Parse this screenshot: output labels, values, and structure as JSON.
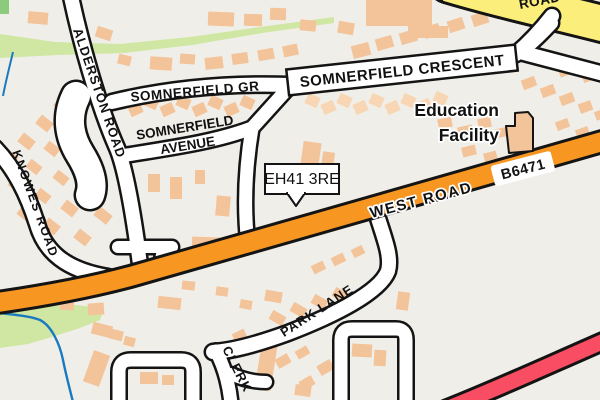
{
  "map": {
    "postcode_callout": {
      "text": "EH41 3RE"
    },
    "labels": {
      "alderston_road": "ALDERSTON ROAD",
      "somnerfield_gr": "SOMNERFIELD GR",
      "somnerfield_crescent": "SOMNERFIELD CRESCENT",
      "somnerfield_avenue_line1": "SOMNERFIELD",
      "somnerfield_avenue_line2": "AVENUE",
      "knowes_road": "KNOWES ROAD",
      "west_road": "WEST ROAD",
      "route_ref": "B6471",
      "park_lane": "PARK LANE",
      "clerk_partial": "CLERK",
      "top_road_partial": "ROAD",
      "education_facility_line1": "Education",
      "education_facility_line2": "Facility"
    },
    "colors": {
      "background": "#f0eee8",
      "building": "#f3c39a",
      "building_light": "#f8d6b4",
      "green_area": "#cfe7a2",
      "green_dark": "#8ccb7d",
      "stream_blue": "#1a7ac0",
      "road_outline": "#141414",
      "road_white": "#ffffff",
      "road_orange": "#f79722",
      "road_yellow": "#fbee7a",
      "road_red": "#f84d62"
    },
    "buildings": [
      [
        55,
        100,
        15,
        11,
        38
      ],
      [
        37,
        118,
        15,
        11,
        38
      ],
      [
        19,
        136,
        15,
        11,
        38
      ],
      [
        3,
        152,
        14,
        10,
        38
      ],
      [
        63,
        126,
        14,
        10,
        38
      ],
      [
        45,
        144,
        14,
        10,
        38
      ],
      [
        27,
        162,
        14,
        10,
        38
      ],
      [
        9,
        180,
        14,
        10,
        38
      ],
      [
        72,
        155,
        14,
        10,
        38
      ],
      [
        54,
        173,
        14,
        10,
        38
      ],
      [
        36,
        191,
        14,
        10,
        38
      ],
      [
        18,
        209,
        14,
        10,
        38
      ],
      [
        80,
        185,
        15,
        11,
        38
      ],
      [
        62,
        203,
        15,
        11,
        38
      ],
      [
        44,
        221,
        15,
        11,
        38
      ],
      [
        95,
        210,
        16,
        11,
        38
      ],
      [
        75,
        232,
        15,
        11,
        38
      ],
      [
        28,
        12,
        20,
        12,
        5
      ],
      [
        96,
        28,
        16,
        11,
        18
      ],
      [
        118,
        55,
        13,
        10,
        14
      ],
      [
        150,
        57,
        22,
        13,
        4
      ],
      [
        180,
        54,
        15,
        10,
        4
      ],
      [
        208,
        12,
        26,
        14,
        2
      ],
      [
        244,
        14,
        18,
        12,
        2
      ],
      [
        270,
        8,
        16,
        12,
        2
      ],
      [
        300,
        20,
        16,
        11,
        6
      ],
      [
        338,
        22,
        16,
        12,
        10
      ],
      [
        366,
        0,
        66,
        26,
        0
      ],
      [
        408,
        26,
        40,
        12,
        0
      ],
      [
        352,
        44,
        18,
        13,
        -14
      ],
      [
        376,
        37,
        17,
        12,
        -16
      ],
      [
        400,
        31,
        17,
        12,
        -16
      ],
      [
        424,
        25,
        16,
        12,
        -16
      ],
      [
        448,
        19,
        16,
        12,
        -18
      ],
      [
        472,
        13,
        16,
        12,
        -18
      ],
      [
        205,
        57,
        18,
        12,
        -6
      ],
      [
        232,
        53,
        16,
        11,
        -8
      ],
      [
        258,
        49,
        16,
        11,
        -10
      ],
      [
        283,
        45,
        15,
        11,
        -12
      ],
      [
        113,
        97,
        13,
        11,
        24
      ],
      [
        129,
        104,
        13,
        11,
        -24
      ],
      [
        145,
        97,
        13,
        11,
        24
      ],
      [
        161,
        104,
        13,
        11,
        -24
      ],
      [
        177,
        97,
        13,
        11,
        24
      ],
      [
        193,
        104,
        13,
        11,
        -24
      ],
      [
        209,
        97,
        13,
        11,
        24
      ],
      [
        225,
        104,
        13,
        11,
        -24
      ],
      [
        241,
        97,
        13,
        11,
        24
      ],
      [
        306,
        95,
        13,
        11,
        24,
        1
      ],
      [
        322,
        102,
        13,
        11,
        -24,
        1
      ],
      [
        338,
        95,
        13,
        11,
        24,
        1
      ],
      [
        354,
        102,
        13,
        11,
        -24,
        1
      ],
      [
        370,
        95,
        13,
        11,
        24,
        1
      ],
      [
        386,
        102,
        13,
        11,
        -24,
        1
      ],
      [
        402,
        95,
        13,
        11,
        24,
        1
      ],
      [
        418,
        100,
        13,
        11,
        -24,
        1
      ],
      [
        434,
        93,
        13,
        11,
        24,
        1
      ],
      [
        522,
        78,
        14,
        10,
        -20
      ],
      [
        541,
        86,
        14,
        10,
        -20
      ],
      [
        560,
        94,
        14,
        10,
        -20
      ],
      [
        579,
        102,
        13,
        10,
        -20
      ],
      [
        595,
        110,
        12,
        9,
        -20
      ],
      [
        556,
        120,
        13,
        9,
        -20
      ],
      [
        576,
        128,
        13,
        9,
        -20
      ],
      [
        592,
        136,
        11,
        9,
        -20
      ],
      [
        558,
        62,
        18,
        13,
        -20
      ],
      [
        582,
        70,
        14,
        11,
        -20
      ],
      [
        438,
        118,
        14,
        10,
        -12
      ],
      [
        458,
        126,
        15,
        11,
        -12
      ],
      [
        478,
        118,
        13,
        10,
        -12
      ],
      [
        496,
        128,
        12,
        9,
        -12
      ],
      [
        462,
        146,
        14,
        10,
        -14
      ],
      [
        484,
        152,
        13,
        10,
        -14
      ],
      [
        148,
        174,
        12,
        18,
        0
      ],
      [
        170,
        177,
        12,
        22,
        0
      ],
      [
        195,
        170,
        10,
        14,
        0
      ],
      [
        192,
        237,
        28,
        11,
        2
      ],
      [
        216,
        196,
        14,
        20,
        5
      ],
      [
        302,
        142,
        18,
        24,
        8
      ],
      [
        322,
        152,
        12,
        16,
        8
      ],
      [
        288,
        170,
        13,
        10,
        10
      ],
      [
        60,
        300,
        14,
        10,
        2
      ],
      [
        88,
        303,
        16,
        12,
        -4
      ],
      [
        92,
        324,
        20,
        12,
        14
      ],
      [
        110,
        330,
        13,
        10,
        14
      ],
      [
        124,
        337,
        11,
        9,
        14
      ],
      [
        158,
        297,
        23,
        12,
        6
      ],
      [
        182,
        281,
        13,
        9,
        6
      ],
      [
        216,
        287,
        12,
        9,
        8
      ],
      [
        240,
        300,
        12,
        9,
        10
      ],
      [
        265,
        291,
        17,
        11,
        10
      ],
      [
        270,
        313,
        15,
        10,
        30
      ],
      [
        291,
        305,
        15,
        10,
        30
      ],
      [
        312,
        297,
        15,
        10,
        30
      ],
      [
        333,
        290,
        15,
        10,
        30
      ],
      [
        258,
        345,
        16,
        45,
        9
      ],
      [
        88,
        352,
        17,
        33,
        20
      ],
      [
        140,
        372,
        18,
        12,
        0
      ],
      [
        162,
        375,
        12,
        10,
        0
      ],
      [
        312,
        263,
        13,
        9,
        -26
      ],
      [
        332,
        255,
        13,
        9,
        -26
      ],
      [
        352,
        247,
        12,
        9,
        -26
      ],
      [
        233,
        331,
        13,
        9,
        -26
      ],
      [
        252,
        338,
        14,
        10,
        -15
      ],
      [
        276,
        356,
        14,
        10,
        -30
      ],
      [
        296,
        348,
        13,
        9,
        -30
      ],
      [
        318,
        362,
        15,
        11,
        -30
      ],
      [
        300,
        378,
        14,
        10,
        -30
      ],
      [
        345,
        302,
        14,
        9,
        -30
      ],
      [
        352,
        344,
        20,
        13,
        3
      ],
      [
        374,
        350,
        12,
        16,
        3
      ],
      [
        397,
        292,
        12,
        18,
        8
      ],
      [
        295,
        385,
        16,
        11,
        8
      ]
    ],
    "education_building_path": "M506,126 L515,126 L515,113 L528,112 L533,118 L533,151 L509,153 Z"
  }
}
